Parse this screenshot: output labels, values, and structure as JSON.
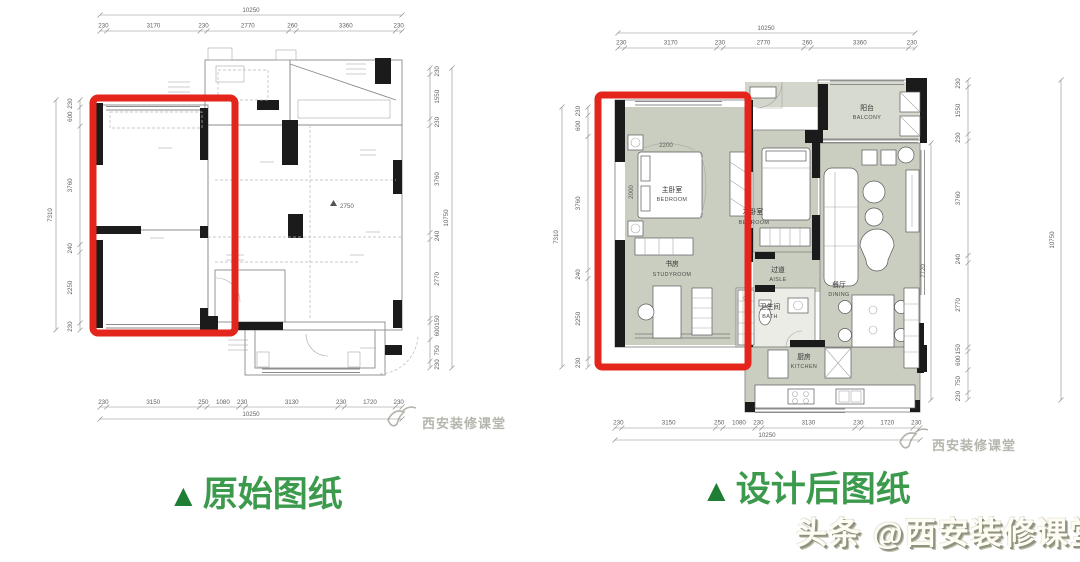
{
  "captions": {
    "original": {
      "marker": "▲",
      "label": "原始图纸"
    },
    "designed": {
      "marker": "▲",
      "label": "设计后图纸"
    }
  },
  "watermark": {
    "brand": "西安装修课堂",
    "platform_credit": "头条 @西安装修课堂"
  },
  "dims": {
    "overall_width": "10250",
    "overall_height_left": "7310",
    "overall_height_right": "10750",
    "inner_right": "7720",
    "top": [
      "230",
      "3170",
      "230",
      "2770",
      "260",
      "3360",
      "230"
    ],
    "bottom": [
      "230",
      "3150",
      "250",
      "1080",
      "230",
      "3130",
      "230",
      "1720",
      "230"
    ],
    "left": [
      "230",
      "600",
      "3760",
      "240",
      "2250",
      "230"
    ],
    "right": [
      "230",
      "1550",
      "230",
      "3760",
      "240",
      "2770",
      "150",
      "600",
      "750",
      "230"
    ]
  },
  "original_plan": {
    "level_mark": "2750"
  },
  "designed_plan": {
    "rooms": {
      "balcony": {
        "cn": "阳台",
        "en": "BALCONY"
      },
      "master_bedroom": {
        "cn": "主卧室",
        "en": "BEDROOM"
      },
      "second_bedroom": {
        "cn": "次卧室",
        "en": "BEDROOM"
      },
      "study": {
        "cn": "书房",
        "en": "STUDYROOM"
      },
      "aisle": {
        "cn": "过道",
        "en": "AISLE"
      },
      "bath": {
        "cn": "卫生间",
        "en": "BATH"
      },
      "dining": {
        "cn": "餐厅",
        "en": "DINING"
      },
      "kitchen": {
        "cn": "厨房",
        "en": "KITCHEN"
      }
    },
    "bed": {
      "width": "2200",
      "depth": "2000"
    }
  },
  "colors": {
    "highlight_red": "#e4251b",
    "caption_green": "#3c9a4c",
    "caption_marker_green": "#1e7e35",
    "room_gray": "#cacec1",
    "balcony_gray": "#d7dacf",
    "wall_black": "#1b1b1b",
    "watermark_gray": "#b5b5ad"
  }
}
